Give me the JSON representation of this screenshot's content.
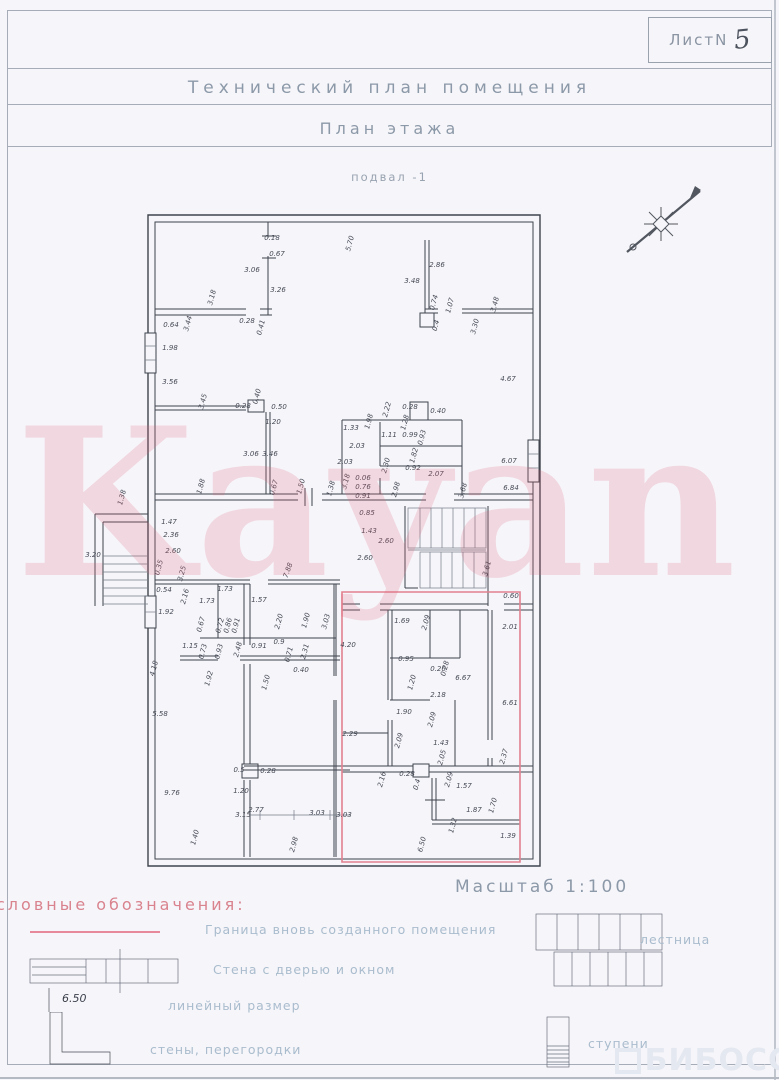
{
  "sheet": {
    "label": "ЛистN",
    "number": "5"
  },
  "titles": {
    "main": "Технический план помещения",
    "sub": "План этажа",
    "level": "подвал -1",
    "scale": "Масштаб 1:100"
  },
  "legend": {
    "heading": "словные обозначения:",
    "items": [
      {
        "symbol": "boundary-pink-line",
        "label": "Граница вновь созданного помещения"
      },
      {
        "symbol": "wall-with-door-and-window",
        "label": "Стена с дверью и окном"
      },
      {
        "symbol": "linear-dimension",
        "sample": "6.50",
        "label": "линейный размер"
      },
      {
        "symbol": "walls-partitions",
        "label": "стены, перегородки"
      },
      {
        "symbol": "stairs",
        "label": "лестница"
      },
      {
        "symbol": "steps",
        "label": "ступени"
      }
    ]
  },
  "watermarks": {
    "center": "Kayan",
    "corner": "БИБОСС"
  },
  "colors": {
    "boundary_pink": "#e8899b",
    "watermark_pink": "rgba(226,96,115,0.20)",
    "ink": "#3f444d",
    "title_blue_gray": "#8c99a8",
    "legend_blue": "#a9bccd",
    "legend_head_pink": "#d9838e",
    "corner_watermark": "#e4e8f0"
  },
  "plan": {
    "dimensions": [
      {
        "t": "0.18",
        "x": 272,
        "y": 240,
        "r": 0
      },
      {
        "t": "0.67",
        "x": 277,
        "y": 256,
        "r": 0
      },
      {
        "t": "3.06",
        "x": 252,
        "y": 272,
        "r": 0
      },
      {
        "t": "3.26",
        "x": 278,
        "y": 292,
        "r": 0
      },
      {
        "t": "3.18",
        "x": 214,
        "y": 298,
        "r": -75
      },
      {
        "t": "0.64",
        "x": 171,
        "y": 327,
        "r": 0
      },
      {
        "t": "3.44",
        "x": 190,
        "y": 324,
        "r": -75
      },
      {
        "t": "0.28",
        "x": 247,
        "y": 323,
        "r": 0
      },
      {
        "t": "0.41",
        "x": 263,
        "y": 328,
        "r": -75
      },
      {
        "t": "5.70",
        "x": 352,
        "y": 244,
        "r": -75
      },
      {
        "t": "2.86",
        "x": 437,
        "y": 267,
        "r": 0
      },
      {
        "t": "3.48",
        "x": 412,
        "y": 283,
        "r": 0
      },
      {
        "t": "3.48",
        "x": 497,
        "y": 305,
        "r": -75
      },
      {
        "t": "0.74",
        "x": 436,
        "y": 303,
        "r": -75
      },
      {
        "t": "1.07",
        "x": 452,
        "y": 306,
        "r": -75
      },
      {
        "t": "0.4",
        "x": 438,
        "y": 326,
        "r": -75
      },
      {
        "t": "3.30",
        "x": 477,
        "y": 327,
        "r": -75
      },
      {
        "t": "4.67",
        "x": 508,
        "y": 381,
        "r": 0
      },
      {
        "t": "6.07",
        "x": 509,
        "y": 463,
        "r": 0
      },
      {
        "t": "6.84",
        "x": 511,
        "y": 490,
        "r": 0
      },
      {
        "t": "1.98",
        "x": 170,
        "y": 350,
        "r": 0
      },
      {
        "t": "3.56",
        "x": 170,
        "y": 384,
        "r": 0
      },
      {
        "t": "3.45",
        "x": 205,
        "y": 402,
        "r": -75
      },
      {
        "t": "0.28",
        "x": 243,
        "y": 408,
        "r": 0
      },
      {
        "t": "0.40",
        "x": 259,
        "y": 397,
        "r": -75
      },
      {
        "t": "0.50",
        "x": 279,
        "y": 409,
        "r": 0
      },
      {
        "t": "1.20",
        "x": 273,
        "y": 424,
        "r": 0
      },
      {
        "t": "3.06",
        "x": 251,
        "y": 456,
        "r": 0
      },
      {
        "t": "3.46",
        "x": 270,
        "y": 456,
        "r": 0
      },
      {
        "t": "1.88",
        "x": 203,
        "y": 487,
        "r": -75
      },
      {
        "t": "0.67",
        "x": 276,
        "y": 488,
        "r": -75
      },
      {
        "t": "1.50",
        "x": 303,
        "y": 487,
        "r": -75
      },
      {
        "t": "1.38",
        "x": 333,
        "y": 489,
        "r": -75
      },
      {
        "t": "2.22",
        "x": 389,
        "y": 410,
        "r": -75
      },
      {
        "t": "0.28",
        "x": 410,
        "y": 409,
        "r": 0
      },
      {
        "t": "0.40",
        "x": 438,
        "y": 413,
        "r": 0
      },
      {
        "t": "1.33",
        "x": 351,
        "y": 430,
        "r": 0
      },
      {
        "t": "1.98",
        "x": 371,
        "y": 422,
        "r": -75
      },
      {
        "t": "1.11",
        "x": 389,
        "y": 437,
        "r": 0
      },
      {
        "t": "0.99",
        "x": 410,
        "y": 437,
        "r": 0
      },
      {
        "t": "0.93",
        "x": 424,
        "y": 438,
        "r": -75
      },
      {
        "t": "1.28",
        "x": 407,
        "y": 423,
        "r": -75
      },
      {
        "t": "2.03",
        "x": 357,
        "y": 448,
        "r": 0
      },
      {
        "t": "2.03",
        "x": 345,
        "y": 464,
        "r": 0
      },
      {
        "t": "2.30",
        "x": 388,
        "y": 466,
        "r": -75
      },
      {
        "t": "1.82",
        "x": 416,
        "y": 456,
        "r": -75
      },
      {
        "t": "0.92",
        "x": 413,
        "y": 470,
        "r": 0
      },
      {
        "t": "2.07",
        "x": 436,
        "y": 476,
        "r": 0
      },
      {
        "t": "3.68",
        "x": 465,
        "y": 491,
        "r": -75
      },
      {
        "t": "3.18",
        "x": 348,
        "y": 482,
        "r": -75
      },
      {
        "t": "0.06",
        "x": 363,
        "y": 480,
        "r": 0
      },
      {
        "t": "0.76",
        "x": 363,
        "y": 489,
        "r": 0
      },
      {
        "t": "0.91",
        "x": 363,
        "y": 498,
        "r": 0
      },
      {
        "t": "2.98",
        "x": 398,
        "y": 490,
        "r": -75
      },
      {
        "t": "0.85",
        "x": 367,
        "y": 515,
        "r": 0
      },
      {
        "t": "1.43",
        "x": 369,
        "y": 533,
        "r": 0
      },
      {
        "t": "2.60",
        "x": 386,
        "y": 543,
        "r": 0
      },
      {
        "t": "2.60",
        "x": 365,
        "y": 560,
        "r": 0
      },
      {
        "t": "3.61",
        "x": 489,
        "y": 569,
        "r": -75
      },
      {
        "t": "0.60",
        "x": 511,
        "y": 598,
        "r": 0
      },
      {
        "t": "2.01",
        "x": 510,
        "y": 629,
        "r": 0
      },
      {
        "t": "1.47",
        "x": 169,
        "y": 524,
        "r": 0
      },
      {
        "t": "2.36",
        "x": 171,
        "y": 537,
        "r": 0
      },
      {
        "t": "2.60",
        "x": 173,
        "y": 553,
        "r": 0
      },
      {
        "t": "0.35",
        "x": 161,
        "y": 568,
        "r": -75
      },
      {
        "t": "3.25",
        "x": 184,
        "y": 574,
        "r": -75
      },
      {
        "t": "0.54",
        "x": 164,
        "y": 592,
        "r": 0
      },
      {
        "t": "2.16",
        "x": 187,
        "y": 597,
        "r": -75
      },
      {
        "t": "1.92",
        "x": 166,
        "y": 614,
        "r": 0
      },
      {
        "t": "3.20",
        "x": 93,
        "y": 557,
        "r": 0
      },
      {
        "t": "1.38",
        "x": 124,
        "y": 498,
        "r": -75
      },
      {
        "t": "7.88",
        "x": 290,
        "y": 571,
        "r": -70
      },
      {
        "t": "1.73",
        "x": 225,
        "y": 591,
        "r": 0
      },
      {
        "t": "1.73",
        "x": 207,
        "y": 603,
        "r": 0
      },
      {
        "t": "1.57",
        "x": 259,
        "y": 602,
        "r": 0
      },
      {
        "t": "0.67",
        "x": 203,
        "y": 625,
        "r": -75
      },
      {
        "t": "0.72",
        "x": 222,
        "y": 626,
        "r": -75
      },
      {
        "t": "0.86",
        "x": 230,
        "y": 626,
        "r": -75
      },
      {
        "t": "0.91",
        "x": 238,
        "y": 626,
        "r": -75
      },
      {
        "t": "2.20",
        "x": 281,
        "y": 622,
        "r": -75
      },
      {
        "t": "1.90",
        "x": 308,
        "y": 621,
        "r": -75
      },
      {
        "t": "3.03",
        "x": 328,
        "y": 622,
        "r": -75
      },
      {
        "t": "1.15",
        "x": 190,
        "y": 648,
        "r": 0
      },
      {
        "t": "0.73",
        "x": 205,
        "y": 652,
        "r": -75
      },
      {
        "t": "0.93",
        "x": 221,
        "y": 652,
        "r": -75
      },
      {
        "t": "2.48",
        "x": 240,
        "y": 650,
        "r": -75
      },
      {
        "t": "0.91",
        "x": 259,
        "y": 648,
        "r": 0
      },
      {
        "t": "0.9",
        "x": 279,
        "y": 644,
        "r": 0
      },
      {
        "t": "0.71",
        "x": 291,
        "y": 655,
        "r": -75
      },
      {
        "t": "2.31",
        "x": 307,
        "y": 652,
        "r": -75
      },
      {
        "t": "0.40",
        "x": 301,
        "y": 672,
        "r": 0
      },
      {
        "t": "1.50",
        "x": 268,
        "y": 683,
        "r": -75
      },
      {
        "t": "1.92",
        "x": 211,
        "y": 679,
        "r": -75
      },
      {
        "t": "4.18",
        "x": 156,
        "y": 669,
        "r": -75
      },
      {
        "t": "5.58",
        "x": 160,
        "y": 716,
        "r": 0
      },
      {
        "t": "4.20",
        "x": 348,
        "y": 647,
        "r": 0
      },
      {
        "t": "1.69",
        "x": 402,
        "y": 623,
        "r": 0
      },
      {
        "t": "2.09",
        "x": 428,
        "y": 623,
        "r": -75
      },
      {
        "t": "0.95",
        "x": 406,
        "y": 661,
        "r": 0
      },
      {
        "t": "0.26",
        "x": 438,
        "y": 671,
        "r": 0
      },
      {
        "t": "0.28",
        "x": 447,
        "y": 669,
        "r": -75
      },
      {
        "t": "6.67",
        "x": 463,
        "y": 680,
        "r": 0
      },
      {
        "t": "1.20",
        "x": 414,
        "y": 683,
        "r": -75
      },
      {
        "t": "2.18",
        "x": 438,
        "y": 697,
        "r": 0
      },
      {
        "t": "1.90",
        "x": 404,
        "y": 714,
        "r": 0
      },
      {
        "t": "2.09",
        "x": 434,
        "y": 720,
        "r": -75
      },
      {
        "t": "6.61",
        "x": 510,
        "y": 705,
        "r": 0
      },
      {
        "t": "2.29",
        "x": 350,
        "y": 736,
        "r": 0
      },
      {
        "t": "2.09",
        "x": 401,
        "y": 741,
        "r": -75
      },
      {
        "t": "1.43",
        "x": 441,
        "y": 745,
        "r": 0
      },
      {
        "t": "9.76",
        "x": 172,
        "y": 795,
        "r": 0
      },
      {
        "t": "1.40",
        "x": 197,
        "y": 838,
        "r": -75
      },
      {
        "t": "0.5",
        "x": 239,
        "y": 772,
        "r": 0
      },
      {
        "t": "0.28",
        "x": 268,
        "y": 773,
        "r": 0
      },
      {
        "t": "1.20",
        "x": 241,
        "y": 793,
        "r": 0
      },
      {
        "t": "2.77",
        "x": 256,
        "y": 812,
        "r": 0
      },
      {
        "t": "3.15",
        "x": 243,
        "y": 817,
        "r": 0
      },
      {
        "t": "3.03",
        "x": 317,
        "y": 815,
        "r": 0
      },
      {
        "t": "3.03",
        "x": 344,
        "y": 817,
        "r": 0
      },
      {
        "t": "2.98",
        "x": 296,
        "y": 845,
        "r": -75
      },
      {
        "t": "2.16",
        "x": 384,
        "y": 780,
        "r": -75
      },
      {
        "t": "0.28",
        "x": 407,
        "y": 776,
        "r": 0
      },
      {
        "t": "0.4",
        "x": 419,
        "y": 785,
        "r": -75
      },
      {
        "t": "2.09",
        "x": 451,
        "y": 780,
        "r": -75
      },
      {
        "t": "2.05",
        "x": 444,
        "y": 758,
        "r": -75
      },
      {
        "t": "2.37",
        "x": 506,
        "y": 757,
        "r": -75
      },
      {
        "t": "1.57",
        "x": 464,
        "y": 788,
        "r": 0
      },
      {
        "t": "1.87",
        "x": 474,
        "y": 812,
        "r": 0
      },
      {
        "t": "1.70",
        "x": 495,
        "y": 806,
        "r": -75
      },
      {
        "t": "1.32",
        "x": 455,
        "y": 826,
        "r": -75
      },
      {
        "t": "1.39",
        "x": 508,
        "y": 838,
        "r": 0
      },
      {
        "t": "6.50",
        "x": 424,
        "y": 845,
        "r": -75
      }
    ]
  }
}
